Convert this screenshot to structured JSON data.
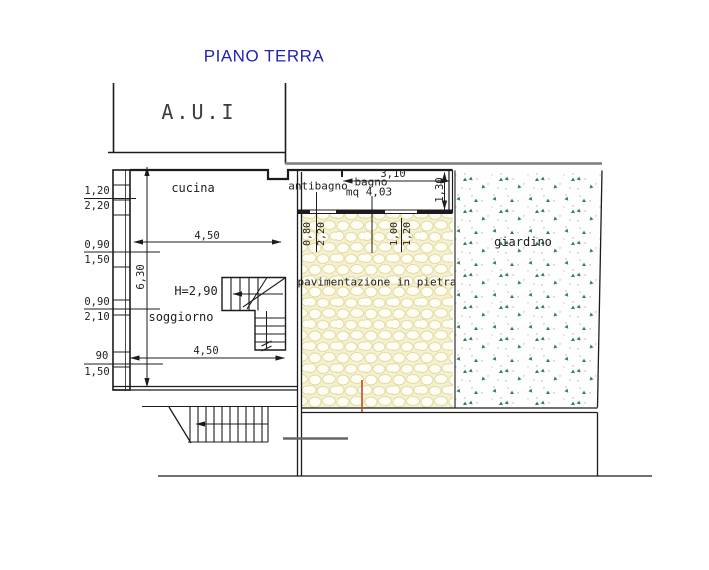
{
  "title": "PIANO TERRA",
  "unit": {
    "label": "A.U.I"
  },
  "rooms": {
    "cucina": "cucina",
    "soggiorno": "soggiorno",
    "antibagno": "antibagno",
    "bagno": "bagno",
    "bagno_area": "mq 4,03",
    "giardino": "giardino",
    "paving": "pavimentazione in pietra",
    "ceiling_height": "H=2,90"
  },
  "dimensions": {
    "left_pairs": [
      {
        "top": "1,20",
        "bottom": "2,20"
      },
      {
        "top": "0,90",
        "bottom": "1,50"
      },
      {
        "top": "0,90",
        "bottom": "2,10"
      },
      {
        "top": "90",
        "bottom": "1,50"
      }
    ],
    "room_width_upper": "4,50",
    "room_width_lower": "4,50",
    "room_depth": "6,30",
    "bagno_width": "3,10",
    "bagno_depth": "1,30",
    "opening_pairs": [
      {
        "w": "0,80",
        "h": "2,20"
      },
      {
        "w": "1,00",
        "h": "1,20"
      }
    ]
  },
  "colors": {
    "title_blue": "#2323b0",
    "line_black": "#1c1c1c",
    "boundary_gray": "#7d7d7d",
    "paving_bg": "#f5f1d0",
    "garden_green": "#2e7d5b",
    "accent_line": "#c14a28"
  }
}
